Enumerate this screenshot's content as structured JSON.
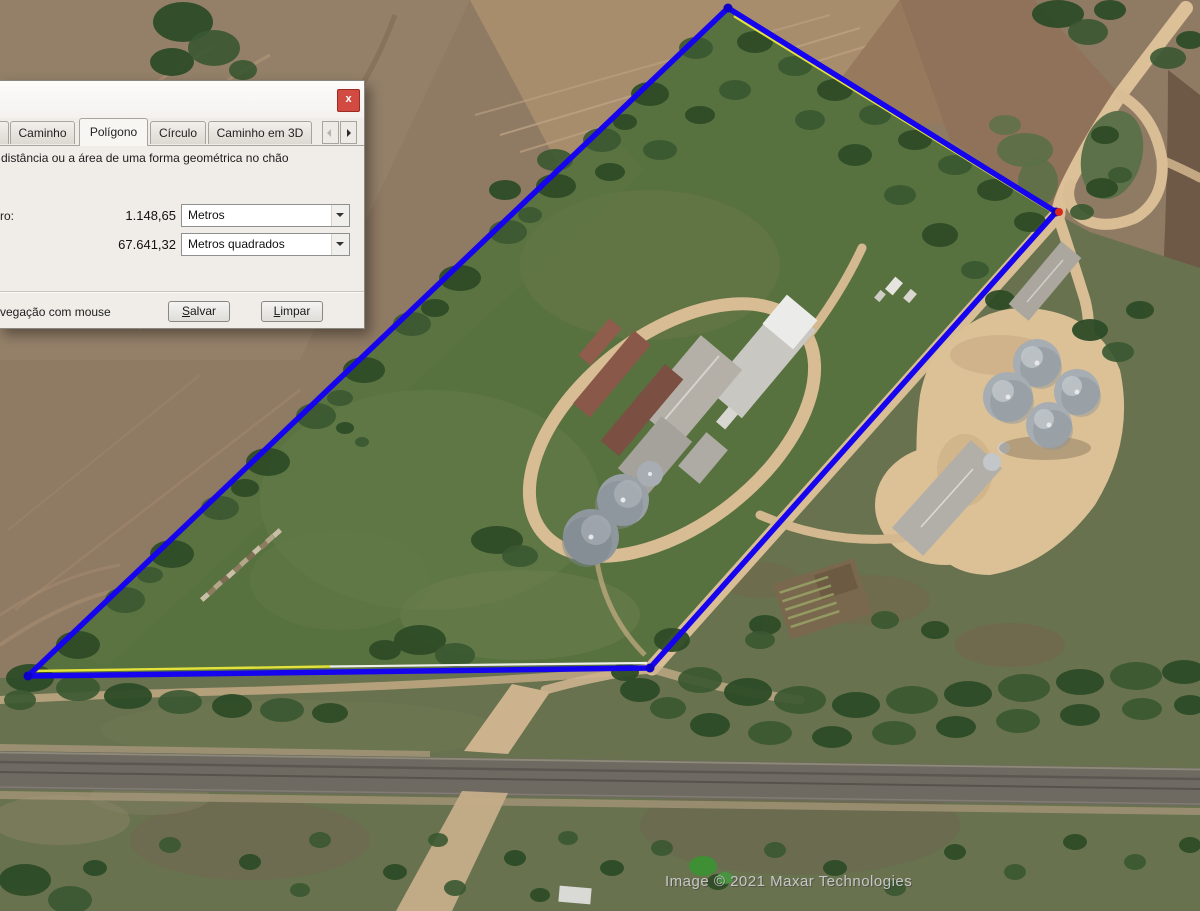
{
  "ruler_dialog": {
    "close": "x",
    "tabs": {
      "items": [
        {
          "label": "Caminho",
          "active": false
        },
        {
          "label": "Polígono",
          "active": true
        },
        {
          "label": "Círculo",
          "active": false
        },
        {
          "label": "Caminho em 3D",
          "active": false
        }
      ]
    },
    "description": "distância ou a área de uma forma geométrica no chão",
    "perimeter": {
      "label": "ro:",
      "value": "1.148,65",
      "unit": "Metros"
    },
    "area": {
      "value": "67.641,32",
      "unit": "Metros quadrados"
    },
    "footer": {
      "mouse_nav": "vegação com mouse",
      "save": "Salvar",
      "clear": "Limpar"
    }
  },
  "map": {
    "credit": "Image © 2021 Maxar Technologies"
  },
  "icons": {
    "close": "x",
    "combo_arrow": "chevron-down",
    "tab_scroll_left": "chevron-left",
    "tab_scroll_right": "chevron-right"
  },
  "colors": {
    "polygon_blue": "#1604ee",
    "ruler_yellow": "#e3e23a",
    "ruler_white": "#f0f0ea",
    "vertex_red": "#d8281c",
    "close_button_red": "#d24b42"
  }
}
